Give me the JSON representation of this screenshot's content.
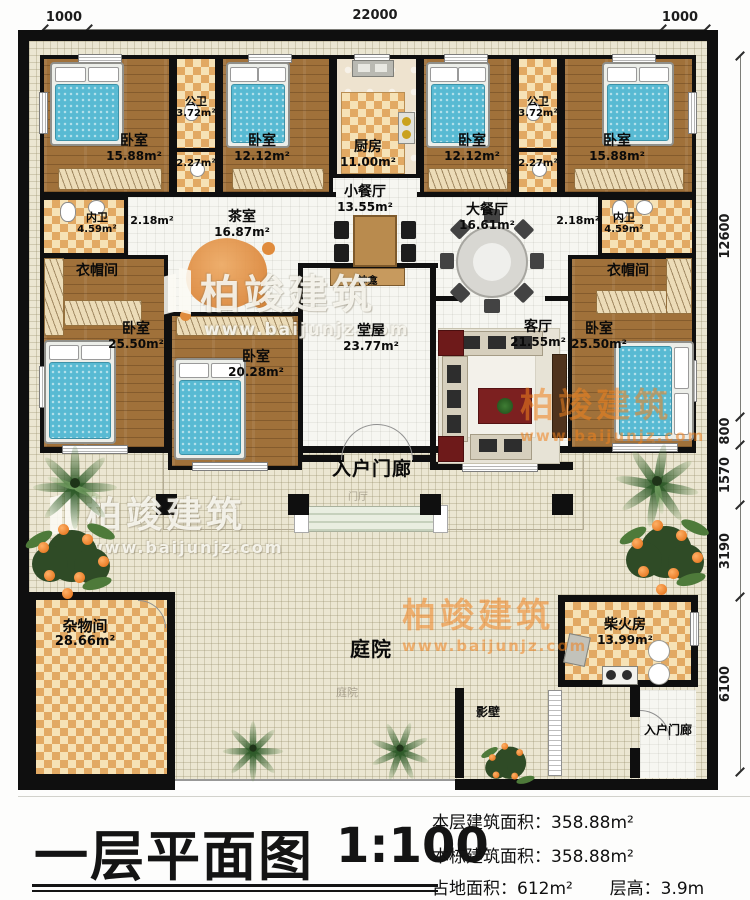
{
  "watermark": {
    "brand": "柏竣建筑",
    "url": "www.baijunjz.com"
  },
  "dimensions": {
    "top": {
      "left": "1000",
      "middle": "22000",
      "right": "1000"
    },
    "right": {
      "d1": "12600",
      "d2": "800",
      "d3": "1570",
      "d4": "3190",
      "d5": "6100"
    }
  },
  "rooms": {
    "bedroom_top_left": {
      "label": "卧室",
      "area": "15.88m²"
    },
    "bath_top_left": {
      "label": "公卫",
      "area": "3.72m²"
    },
    "corridor_top_left": {
      "area": "2.27m²"
    },
    "bedroom_top_left2": {
      "label": "卧室",
      "area": "12.12m²"
    },
    "kitchen": {
      "label": "厨房",
      "area": "11.00m²"
    },
    "bedroom_top_right2": {
      "label": "卧室",
      "area": "12.12m²"
    },
    "bath_top_right": {
      "label": "公卫",
      "area": "3.72m²"
    },
    "corridor_top_right": {
      "area": "2.27m²"
    },
    "bedroom_top_right": {
      "label": "卧室",
      "area": "15.88m²"
    },
    "wc_left": {
      "label": "内卫",
      "area": "4.59m²"
    },
    "hall_left": {
      "area": "2.18m²"
    },
    "tea_room": {
      "label": "茶室",
      "area": "16.87m²"
    },
    "dining_small": {
      "label": "小餐厅",
      "area": "13.55m²"
    },
    "dining_large": {
      "label": "大餐厅",
      "area": "16.61m²"
    },
    "hall_right": {
      "area": "2.18m²"
    },
    "wc_right": {
      "label": "内卫",
      "area": "4.59m²"
    },
    "cloak_left": {
      "label": "衣帽间"
    },
    "bedroom_left3": {
      "label": "卧室",
      "area": "25.50m²"
    },
    "bedroom_mid": {
      "label": "卧室",
      "area": "20.28m²"
    },
    "shrine": {
      "label": "神龛"
    },
    "main_hall": {
      "label": "堂屋",
      "area": "23.77m²"
    },
    "living": {
      "label": "客厅",
      "area": "21.55m²"
    },
    "cloak_right": {
      "label": "衣帽间"
    },
    "bedroom_right3": {
      "label": "卧室",
      "area": "25.50m²"
    },
    "porch": {
      "label": "入户门廊",
      "ghost": "门厅"
    },
    "storage": {
      "label": "杂物间",
      "area": "28.66m²"
    },
    "courtyard": {
      "label": "庭院",
      "ghost": "庭院"
    },
    "firewood": {
      "label": "柴火房",
      "area": "13.99m²"
    },
    "screen_wall": {
      "label": "影壁"
    },
    "porch2": {
      "label": "入户门廊"
    }
  },
  "title_block": {
    "title": "一层平面图",
    "scale": "1:100",
    "stat1_label": "本层建筑面积：",
    "stat1_value": "358.88m²",
    "stat2_label": "本栋建筑面积：",
    "stat2_value": "358.88m²",
    "stat3_label": "占地面积：",
    "stat3_value": "612m²",
    "stat4_label": "层高：",
    "stat4_value": "3.9m"
  },
  "colors": {
    "wall": "#0f0f0f",
    "wood_floor": "#a0713a",
    "checker": "#e2a963",
    "bed": "#58bad3",
    "watermark_orange": "#f0821e"
  }
}
